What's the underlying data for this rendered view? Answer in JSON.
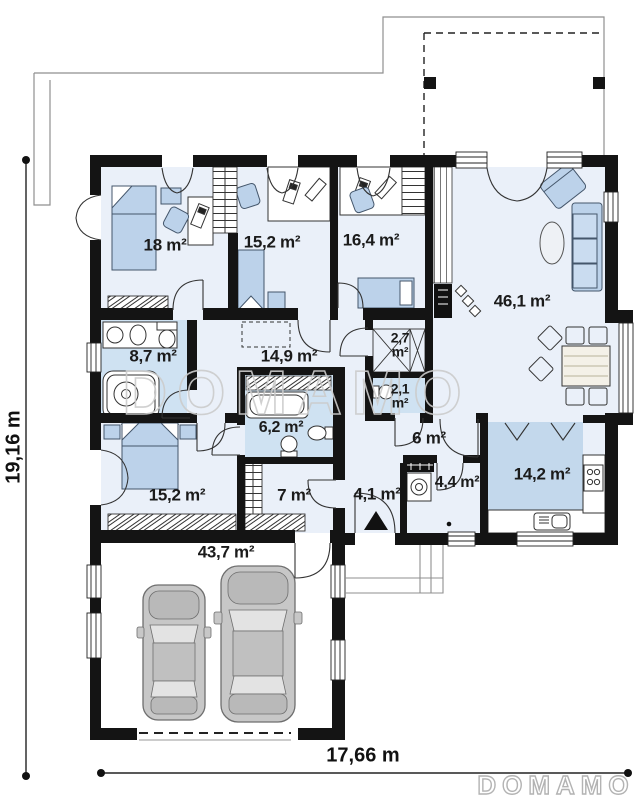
{
  "plan": {
    "rooms": [
      {
        "id": "bedroom-1",
        "area": "18 m²"
      },
      {
        "id": "bedroom-2",
        "area": "15,2 m²"
      },
      {
        "id": "bedroom-3",
        "area": "16,4 m²"
      },
      {
        "id": "living-room",
        "area": "46,1 m²"
      },
      {
        "id": "bathroom-1",
        "area": "8,7 m²"
      },
      {
        "id": "hallway",
        "area": "14,9 m²"
      },
      {
        "id": "pantry",
        "area": "2,7\nm²"
      },
      {
        "id": "wc",
        "area": "2,1\nm²"
      },
      {
        "id": "bathroom-2",
        "area": "6,2 m²"
      },
      {
        "id": "hall",
        "area": "6 m²"
      },
      {
        "id": "vestibule",
        "area": "4,1 m²"
      },
      {
        "id": "utility-room",
        "area": "4,4 m²"
      },
      {
        "id": "kitchen",
        "area": "14,2 m²"
      },
      {
        "id": "bedroom-4",
        "area": "15,2 m²"
      },
      {
        "id": "wardrobe-room",
        "area": "7 m²"
      },
      {
        "id": "garage",
        "area": "43,7 m²"
      }
    ],
    "dimensions": {
      "total_width": "17,66 m",
      "total_height": "19,16 m"
    },
    "watermark_center": "DOMAMO",
    "logo": "DOMAMO"
  },
  "colors": {
    "wall": "#141414",
    "room_fill": "#eaf0f9",
    "wet_room_fill": "#cfe2f2",
    "kitchen_fill": "#c3d8ec",
    "furniture_blue": "#bcd2ea",
    "car_gray": "#c7c7c7",
    "watermark_gray": "#cccccc"
  }
}
